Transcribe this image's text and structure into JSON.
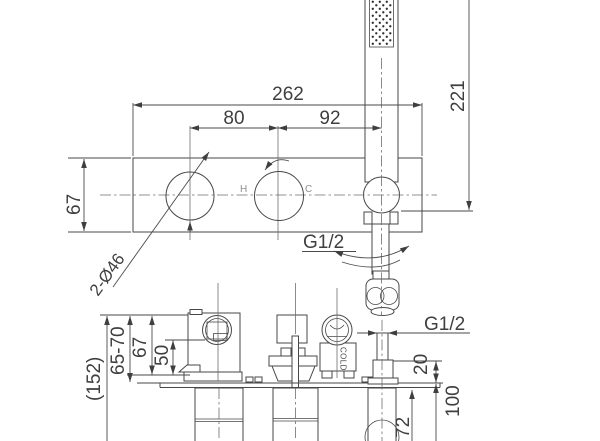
{
  "front_view": {
    "dim_total_width": "262",
    "dim_left_spacing": "80",
    "dim_right_spacing": "92",
    "dim_handshower_height": "221",
    "dim_plate_height": "67",
    "dim_handle_holes": "2-Ø46",
    "hot_label": "H",
    "cold_label": "C",
    "hose_thread_label": "G1/2"
  },
  "side_view": {
    "dim_total_depth": "(152)",
    "dim_install_depth_range": "65-70",
    "dim_body_depth": "67",
    "dim_port_depth": "50",
    "cold_marking": "COLD",
    "outlet_thread_label": "G1/2",
    "dim_outlet_protrusion": "20",
    "dim_outlet_below_plate": "100",
    "dim_outlet_center_offset": "72"
  }
}
